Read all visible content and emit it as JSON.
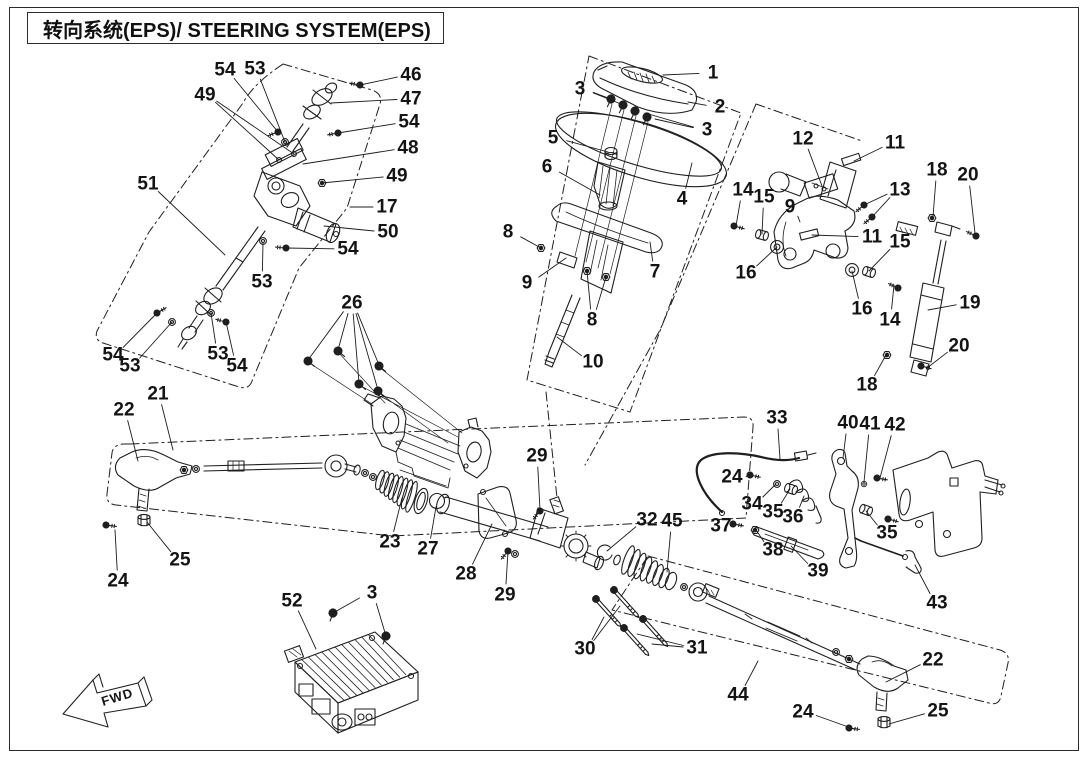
{
  "title": "转向系统(EPS)/ STEERING SYSTEM(EPS)",
  "fwd_label": "FWD",
  "colors": {
    "line": "#1f1f1f",
    "background": "#ffffff",
    "text": "#141414"
  },
  "diagram": {
    "description": "Exploded parts diagram of electric power steering (EPS) system",
    "callouts": [
      {
        "label": "54",
        "x": 225,
        "y": 70,
        "targets": [
          [
            278,
            132
          ]
        ]
      },
      {
        "label": "53",
        "x": 255,
        "y": 69,
        "targets": [
          [
            285,
            142
          ]
        ]
      },
      {
        "label": "49",
        "x": 205,
        "y": 95,
        "targets": [
          [
            279,
            160
          ],
          [
            294,
            154
          ]
        ]
      },
      {
        "label": "46",
        "x": 411,
        "y": 75,
        "targets": [
          [
            360,
            85
          ]
        ]
      },
      {
        "label": "47",
        "x": 411,
        "y": 99,
        "targets": [
          [
            331,
            103
          ]
        ]
      },
      {
        "label": "54",
        "x": 409,
        "y": 122,
        "targets": [
          [
            338,
            133
          ]
        ]
      },
      {
        "label": "48",
        "x": 408,
        "y": 148,
        "targets": [
          [
            303,
            164
          ]
        ]
      },
      {
        "label": "49",
        "x": 397,
        "y": 176,
        "targets": [
          [
            322,
            183
          ]
        ]
      },
      {
        "label": "17",
        "x": 387,
        "y": 207,
        "targets": [
          [
            350,
            207
          ]
        ]
      },
      {
        "label": "50",
        "x": 388,
        "y": 232,
        "targets": [
          [
            324,
            226
          ]
        ]
      },
      {
        "label": "51",
        "x": 148,
        "y": 184,
        "targets": [
          [
            225,
            255
          ]
        ]
      },
      {
        "label": "54",
        "x": 348,
        "y": 249,
        "targets": [
          [
            286,
            248
          ]
        ]
      },
      {
        "label": "53",
        "x": 262,
        "y": 282,
        "targets": [
          [
            263,
            243
          ]
        ]
      },
      {
        "label": "54",
        "x": 113,
        "y": 355,
        "targets": [
          [
            157,
            313
          ]
        ]
      },
      {
        "label": "53",
        "x": 130,
        "y": 366,
        "targets": [
          [
            172,
            322
          ]
        ]
      },
      {
        "label": "53",
        "x": 218,
        "y": 354,
        "targets": [
          [
            211,
            313
          ]
        ]
      },
      {
        "label": "54",
        "x": 237,
        "y": 366,
        "targets": [
          [
            226,
            322
          ]
        ]
      },
      {
        "label": "26",
        "x": 352,
        "y": 303,
        "targets": [
          [
            308,
            360
          ],
          [
            338,
            350
          ],
          [
            359,
            383
          ],
          [
            379,
            365
          ],
          [
            378,
            390
          ]
        ]
      },
      {
        "label": "1",
        "x": 713,
        "y": 73,
        "targets": [
          [
            663,
            75
          ]
        ]
      },
      {
        "label": "2",
        "x": 720,
        "y": 107,
        "targets": [
          [
            688,
            102
          ]
        ]
      },
      {
        "label": "3",
        "x": 580,
        "y": 89,
        "targets": [
          [
            611,
            99
          ],
          [
            621,
            104
          ]
        ]
      },
      {
        "label": "3",
        "x": 707,
        "y": 130,
        "targets": [
          [
            655,
            119
          ],
          [
            645,
            113
          ]
        ]
      },
      {
        "label": "5",
        "x": 553,
        "y": 138,
        "targets": [
          [
            608,
            152
          ]
        ]
      },
      {
        "label": "6",
        "x": 547,
        "y": 167,
        "targets": [
          [
            600,
            195
          ]
        ]
      },
      {
        "label": "4",
        "x": 682,
        "y": 199,
        "targets": [
          [
            692,
            163
          ]
        ]
      },
      {
        "label": "8",
        "x": 508,
        "y": 232,
        "targets": [
          [
            541,
            248
          ]
        ]
      },
      {
        "label": "7",
        "x": 655,
        "y": 272,
        "targets": [
          [
            650,
            242
          ]
        ]
      },
      {
        "label": "9",
        "x": 527,
        "y": 283,
        "targets": [
          [
            566,
            258
          ]
        ]
      },
      {
        "label": "8",
        "x": 592,
        "y": 320,
        "targets": [
          [
            587,
            271
          ],
          [
            606,
            277
          ]
        ]
      },
      {
        "label": "10",
        "x": 593,
        "y": 362,
        "targets": [
          [
            557,
            337
          ]
        ]
      },
      {
        "label": "12",
        "x": 803,
        "y": 139,
        "targets": [
          [
            822,
            186
          ]
        ]
      },
      {
        "label": "11",
        "x": 895,
        "y": 143,
        "targets": [
          [
            854,
            161
          ]
        ]
      },
      {
        "label": "13",
        "x": 900,
        "y": 190,
        "targets": [
          [
            864,
            205
          ],
          [
            872,
            217
          ]
        ]
      },
      {
        "label": "18",
        "x": 937,
        "y": 170,
        "targets": [
          [
            933,
            217
          ]
        ]
      },
      {
        "label": "20",
        "x": 968,
        "y": 175,
        "targets": [
          [
            975,
            233
          ]
        ]
      },
      {
        "label": "14",
        "x": 743,
        "y": 190,
        "targets": [
          [
            736,
            226
          ]
        ]
      },
      {
        "label": "15",
        "x": 764,
        "y": 197,
        "targets": [
          [
            762,
            234
          ]
        ]
      },
      {
        "label": "9",
        "x": 790,
        "y": 207,
        "targets": [
          [
            800,
            222
          ]
        ]
      },
      {
        "label": "11",
        "x": 872,
        "y": 237,
        "targets": [
          [
            812,
            235
          ]
        ]
      },
      {
        "label": "15",
        "x": 900,
        "y": 242,
        "targets": [
          [
            869,
            271
          ]
        ]
      },
      {
        "label": "16",
        "x": 746,
        "y": 273,
        "targets": [
          [
            777,
            247
          ]
        ]
      },
      {
        "label": "16",
        "x": 862,
        "y": 309,
        "targets": [
          [
            852,
            271
          ]
        ]
      },
      {
        "label": "14",
        "x": 890,
        "y": 320,
        "targets": [
          [
            894,
            285
          ]
        ]
      },
      {
        "label": "19",
        "x": 970,
        "y": 303,
        "targets": [
          [
            928,
            310
          ]
        ]
      },
      {
        "label": "20",
        "x": 959,
        "y": 346,
        "targets": [
          [
            927,
            368
          ]
        ]
      },
      {
        "label": "18",
        "x": 867,
        "y": 385,
        "targets": [
          [
            886,
            355
          ]
        ]
      },
      {
        "label": "22",
        "x": 124,
        "y": 410,
        "targets": [
          [
            138,
            461
          ]
        ]
      },
      {
        "label": "21",
        "x": 158,
        "y": 394,
        "targets": [
          [
            173,
            450
          ]
        ]
      },
      {
        "label": "25",
        "x": 180,
        "y": 560,
        "targets": [
          [
            147,
            522
          ]
        ]
      },
      {
        "label": "24",
        "x": 118,
        "y": 581,
        "targets": [
          [
            115,
            530
          ]
        ]
      },
      {
        "label": "23",
        "x": 390,
        "y": 542,
        "targets": [
          [
            402,
            498
          ]
        ]
      },
      {
        "label": "27",
        "x": 428,
        "y": 549,
        "targets": [
          [
            436,
            507
          ]
        ]
      },
      {
        "label": "29",
        "x": 537,
        "y": 456,
        "targets": [
          [
            540,
            510
          ]
        ]
      },
      {
        "label": "28",
        "x": 466,
        "y": 574,
        "targets": [
          [
            492,
            524
          ]
        ]
      },
      {
        "label": "29",
        "x": 505,
        "y": 595,
        "targets": [
          [
            508,
            551
          ]
        ]
      },
      {
        "label": "52",
        "x": 292,
        "y": 601,
        "targets": [
          [
            316,
            649
          ]
        ]
      },
      {
        "label": "3",
        "x": 372,
        "y": 593,
        "targets": [
          [
            333,
            613
          ],
          [
            386,
            636
          ]
        ]
      },
      {
        "label": "32",
        "x": 647,
        "y": 520,
        "targets": [
          [
            607,
            551
          ]
        ]
      },
      {
        "label": "45",
        "x": 672,
        "y": 521,
        "targets": [
          [
            667,
            572
          ]
        ]
      },
      {
        "label": "33",
        "x": 777,
        "y": 418,
        "targets": [
          [
            780,
            459
          ]
        ]
      },
      {
        "label": "40",
        "x": 848,
        "y": 423,
        "targets": [
          [
            843,
            458
          ]
        ]
      },
      {
        "label": "41",
        "x": 870,
        "y": 424,
        "targets": [
          [
            864,
            482
          ]
        ]
      },
      {
        "label": "42",
        "x": 895,
        "y": 425,
        "targets": [
          [
            880,
            478
          ]
        ]
      },
      {
        "label": "24",
        "x": 732,
        "y": 477,
        "targets": [
          [
            751,
            476
          ]
        ]
      },
      {
        "label": "34",
        "x": 752,
        "y": 504,
        "targets": [
          [
            775,
            485
          ]
        ]
      },
      {
        "label": "35",
        "x": 773,
        "y": 512,
        "targets": [
          [
            790,
            489
          ]
        ]
      },
      {
        "label": "36",
        "x": 793,
        "y": 517,
        "targets": [
          [
            804,
            496
          ]
        ]
      },
      {
        "label": "37",
        "x": 721,
        "y": 526,
        "targets": [
          [
            736,
            525
          ]
        ]
      },
      {
        "label": "38",
        "x": 773,
        "y": 550,
        "targets": [
          [
            756,
            530
          ]
        ]
      },
      {
        "label": "39",
        "x": 818,
        "y": 571,
        "targets": [
          [
            791,
            546
          ]
        ]
      },
      {
        "label": "35",
        "x": 887,
        "y": 533,
        "targets": [
          [
            866,
            511
          ]
        ]
      },
      {
        "label": "43",
        "x": 937,
        "y": 603,
        "targets": [
          [
            915,
            565
          ]
        ]
      },
      {
        "label": "30",
        "x": 585,
        "y": 649,
        "targets": [
          [
            604,
            617
          ],
          [
            620,
            606
          ]
        ]
      },
      {
        "label": "31",
        "x": 697,
        "y": 648,
        "targets": [
          [
            652,
            644
          ],
          [
            637,
            634
          ]
        ]
      },
      {
        "label": "44",
        "x": 738,
        "y": 695,
        "targets": [
          [
            758,
            661
          ]
        ]
      },
      {
        "label": "22",
        "x": 933,
        "y": 660,
        "targets": [
          [
            886,
            682
          ]
        ]
      },
      {
        "label": "24",
        "x": 803,
        "y": 712,
        "targets": [
          [
            854,
            729
          ]
        ]
      },
      {
        "label": "25",
        "x": 938,
        "y": 711,
        "targets": [
          [
            889,
            724
          ]
        ]
      }
    ]
  }
}
